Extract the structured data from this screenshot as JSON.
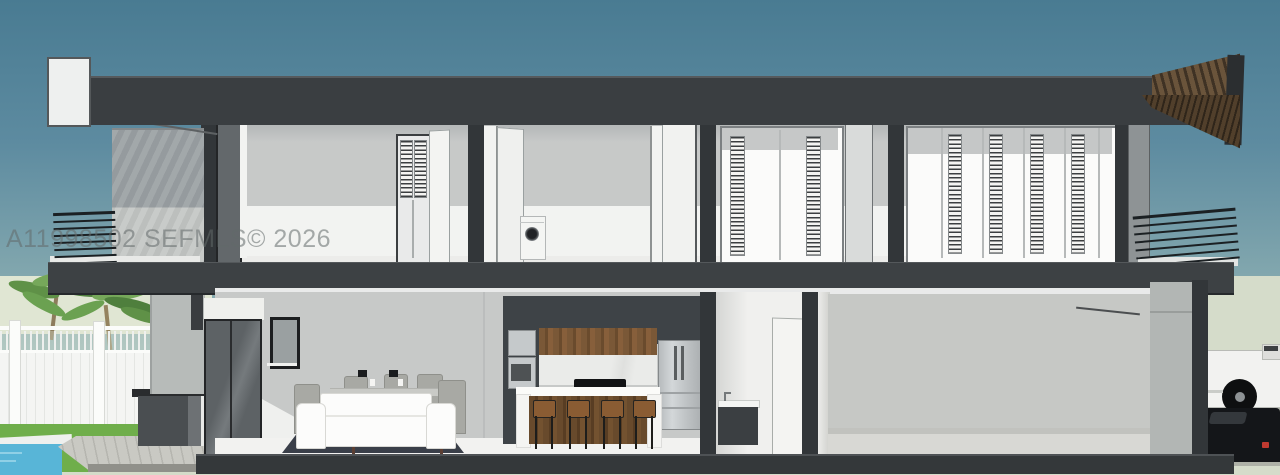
{
  "watermark": {
    "text": "A11998502 SEFMLS© 2026"
  },
  "scene": {
    "type": "architectural-cross-section-3d-rendering",
    "objects": [
      "roof-slab",
      "louvered-shutters",
      "balcony-cable-railings",
      "washing-machine",
      "kitchen-island",
      "bar-stools",
      "refrigerator",
      "wall-ovens",
      "dining-set",
      "sofa",
      "area-rug",
      "powder-room-vanity",
      "garage",
      "palm-trees",
      "swimming-pool",
      "white-fence",
      "wood-deck",
      "outdoor-kitchen",
      "pickup-truck",
      "black-car"
    ]
  },
  "colors": {
    "sky_top": "#497b92",
    "sky_mid": "#82a7ae",
    "horizon": "#c3cfc5",
    "sage": "#d5dcca",
    "sage_light": "#e0e6d3",
    "roof": "#3a3e41",
    "slab": "#3d4144",
    "cut": "#323639",
    "int_wall": "#c7c9c8",
    "int_ceiling": "#adb0b1",
    "white": "#f4f5f3",
    "concrete": "#9ba1a4",
    "ext_wall": "#b7bbb9",
    "glass": "#63686b",
    "frame": "#232527",
    "grass": "#6fae4b",
    "pool": "#58b5d7",
    "deck": "#c7c7c1",
    "cab_dark": "#3e4347",
    "wood": "#7a5837",
    "stainless": "#c5c9cb",
    "sofa": "#fcfcfb",
    "rug": "#3a3f49",
    "chair": "#a8a9a4",
    "stool": "#8a5c33",
    "truck": "#f2f2f0",
    "car": "#141619",
    "taillight": "#c03a30"
  }
}
